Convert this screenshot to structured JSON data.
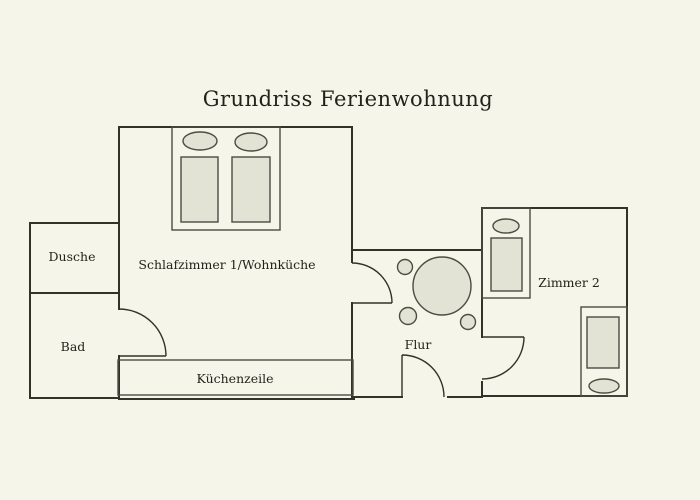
{
  "title": "Grundriss Ferienwohnung",
  "colors": {
    "background": "#f5f5ea",
    "wall": "#32322a",
    "furniture_fill": "#e2e2d5",
    "furniture_line": "#4c4c41",
    "text": "#23231c"
  },
  "rooms": {
    "shower": {
      "label": "Dusche"
    },
    "bath": {
      "label": "Bad"
    },
    "bedroom_living": {
      "label": "Schlafzimmer 1/Wohnküche"
    },
    "kitchenette": {
      "label": "Küchenzeile"
    },
    "hallway": {
      "label": "Flur"
    },
    "room2": {
      "label": "Zimmer 2"
    }
  }
}
